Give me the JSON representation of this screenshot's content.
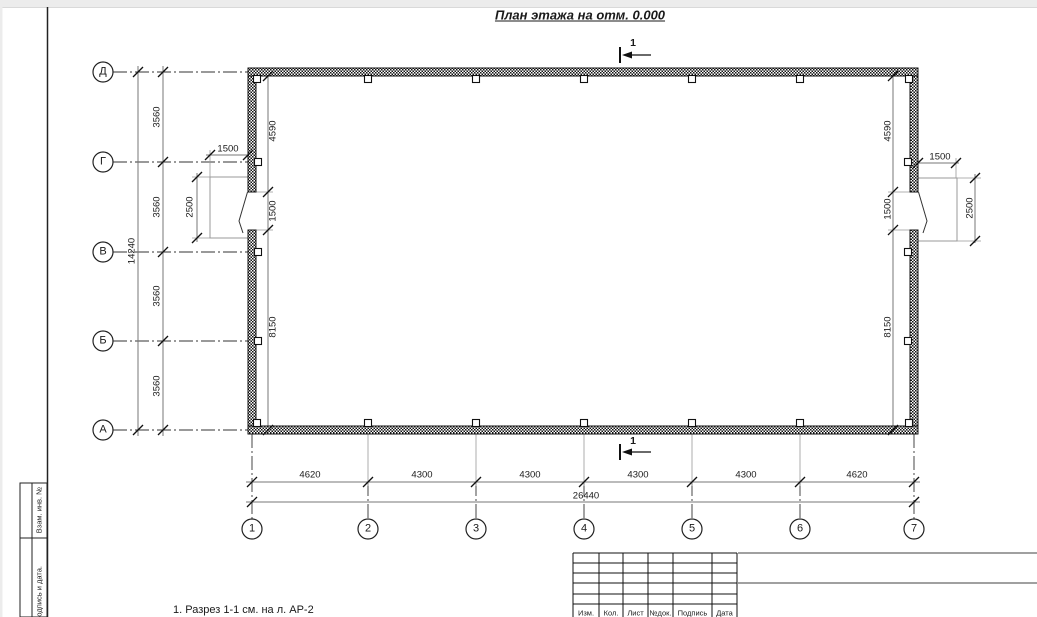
{
  "drawing": {
    "title": "План этажа на отм. 0.000",
    "note": "1. Разрез 1-1 см. на л. АР-2",
    "section_label": "1"
  },
  "axes": {
    "vertical": [
      "Д",
      "Г",
      "В",
      "Б",
      "А"
    ],
    "horizontal": [
      "1",
      "2",
      "3",
      "4",
      "5",
      "6",
      "7"
    ]
  },
  "dims": {
    "bottom_chain": [
      "4620",
      "4300",
      "4300",
      "4300",
      "4300",
      "4620"
    ],
    "bottom_total": "26440",
    "left_chain": [
      "3560",
      "3560",
      "3560",
      "3560"
    ],
    "left_total": "14240",
    "left_wall": [
      "4590",
      "1500",
      "8150"
    ],
    "right_wall": [
      "4590",
      "1500",
      "8150"
    ],
    "left_door": {
      "width": "1500",
      "depth": "2500"
    },
    "right_door": {
      "width": "1500",
      "depth": "2500"
    }
  },
  "stamp": {
    "columns": [
      "Изм.",
      "Кол.",
      "Лист",
      "№док.",
      "Подпись",
      "Дата"
    ]
  },
  "margin_labels": [
    "Взам. инв. №",
    "Подпись и дата."
  ],
  "colors": {
    "line": "#1a1a1a",
    "dim": "#777777",
    "gray_rule": "#808080",
    "paper": "#ffffff",
    "chrome": "#ececec"
  }
}
